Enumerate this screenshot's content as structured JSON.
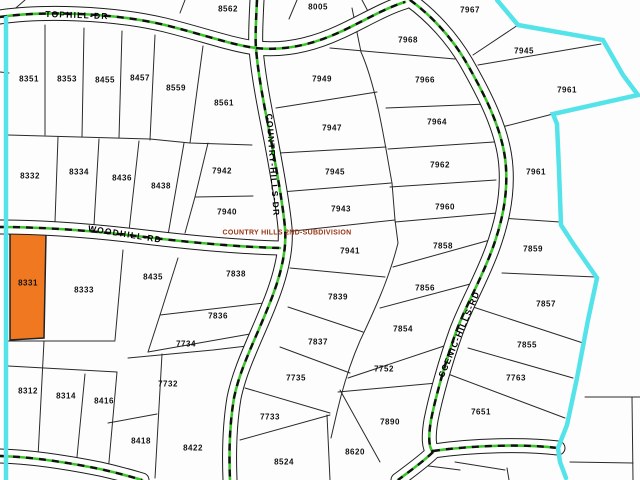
{
  "map": {
    "title": "parcel-plat-map",
    "highlight_color": "#F07820",
    "boundary_color": "#55E3EA",
    "centerline_green": "#3CC52A",
    "highlighted_parcel_id": "8331",
    "subdivision_label": {
      "text": "COUNTRY HILLS 2ND-SUBDIVISION",
      "color": "#993311",
      "x": 287,
      "y": 233
    },
    "road_labels": [
      {
        "name": "TOPHILL-DR",
        "text": "TOPHILL-DR",
        "x": 77,
        "y": 15,
        "rotation": 2
      },
      {
        "name": "WOODHILL-RD",
        "text": "WOODHILL-RD",
        "x": 125,
        "y": 234,
        "rotation": 9
      },
      {
        "name": "COUNTRY-HILLS-DR",
        "text": "COUNTRY-HILLS-DR",
        "x": 273,
        "y": 165,
        "rotation": 86
      },
      {
        "name": "SCENIC-HILLS-RD",
        "text": "SCENIC-HILLS-RD",
        "x": 459,
        "y": 334,
        "rotation": -67
      }
    ],
    "parcels": [
      {
        "id": "8562",
        "x": 228,
        "y": 9
      },
      {
        "id": "8005",
        "x": 318,
        "y": 7
      },
      {
        "id": "7967",
        "x": 470,
        "y": 10
      },
      {
        "id": "8351",
        "x": 29,
        "y": 79
      },
      {
        "id": "8353",
        "x": 67,
        "y": 79
      },
      {
        "id": "8455",
        "x": 105,
        "y": 80
      },
      {
        "id": "8457",
        "x": 140,
        "y": 78
      },
      {
        "id": "8559",
        "x": 176,
        "y": 88
      },
      {
        "id": "8561",
        "x": 224,
        "y": 103
      },
      {
        "id": "7968",
        "x": 408,
        "y": 40
      },
      {
        "id": "7949",
        "x": 322,
        "y": 79
      },
      {
        "id": "7966",
        "x": 425,
        "y": 80
      },
      {
        "id": "7947",
        "x": 332,
        "y": 128
      },
      {
        "id": "7964",
        "x": 437,
        "y": 122
      },
      {
        "id": "7945",
        "x": 335,
        "y": 172
      },
      {
        "id": "7962",
        "x": 440,
        "y": 165
      },
      {
        "id": "7943",
        "x": 341,
        "y": 209
      },
      {
        "id": "7960",
        "x": 445,
        "y": 207
      },
      {
        "id": "7945",
        "x": 524,
        "y": 51
      },
      {
        "id": "7961",
        "x": 567,
        "y": 90
      },
      {
        "id": "7961",
        "x": 536,
        "y": 172
      },
      {
        "id": "8332",
        "x": 30,
        "y": 176
      },
      {
        "id": "8334",
        "x": 79,
        "y": 172
      },
      {
        "id": "8436",
        "x": 122,
        "y": 178
      },
      {
        "id": "8438",
        "x": 161,
        "y": 186
      },
      {
        "id": "7942",
        "x": 222,
        "y": 171
      },
      {
        "id": "7940",
        "x": 227,
        "y": 212
      },
      {
        "id": "8331",
        "x": 28,
        "y": 283
      },
      {
        "id": "8333",
        "x": 84,
        "y": 290
      },
      {
        "id": "8435",
        "x": 153,
        "y": 277
      },
      {
        "id": "7838",
        "x": 236,
        "y": 274
      },
      {
        "id": "7836",
        "x": 218,
        "y": 316
      },
      {
        "id": "7734",
        "x": 186,
        "y": 344
      },
      {
        "id": "7732",
        "x": 168,
        "y": 384
      },
      {
        "id": "8312",
        "x": 28,
        "y": 391
      },
      {
        "id": "8314",
        "x": 66,
        "y": 396
      },
      {
        "id": "8416",
        "x": 104,
        "y": 401
      },
      {
        "id": "8418",
        "x": 141,
        "y": 441
      },
      {
        "id": "8422",
        "x": 193,
        "y": 448
      },
      {
        "id": "7733",
        "x": 270,
        "y": 417
      },
      {
        "id": "7735",
        "x": 296,
        "y": 378
      },
      {
        "id": "8524",
        "x": 284,
        "y": 462
      },
      {
        "id": "8620",
        "x": 355,
        "y": 452
      },
      {
        "id": "7890",
        "x": 390,
        "y": 422
      },
      {
        "id": "7941",
        "x": 350,
        "y": 251
      },
      {
        "id": "7839",
        "x": 338,
        "y": 297
      },
      {
        "id": "7837",
        "x": 318,
        "y": 342
      },
      {
        "id": "7752",
        "x": 384,
        "y": 369
      },
      {
        "id": "7858",
        "x": 443,
        "y": 246
      },
      {
        "id": "7856",
        "x": 425,
        "y": 288
      },
      {
        "id": "7854",
        "x": 403,
        "y": 329
      },
      {
        "id": "7859",
        "x": 533,
        "y": 249
      },
      {
        "id": "7857",
        "x": 546,
        "y": 304
      },
      {
        "id": "7855",
        "x": 527,
        "y": 345
      },
      {
        "id": "7763",
        "x": 516,
        "y": 378
      },
      {
        "id": "7651",
        "x": 481,
        "y": 412
      }
    ]
  }
}
